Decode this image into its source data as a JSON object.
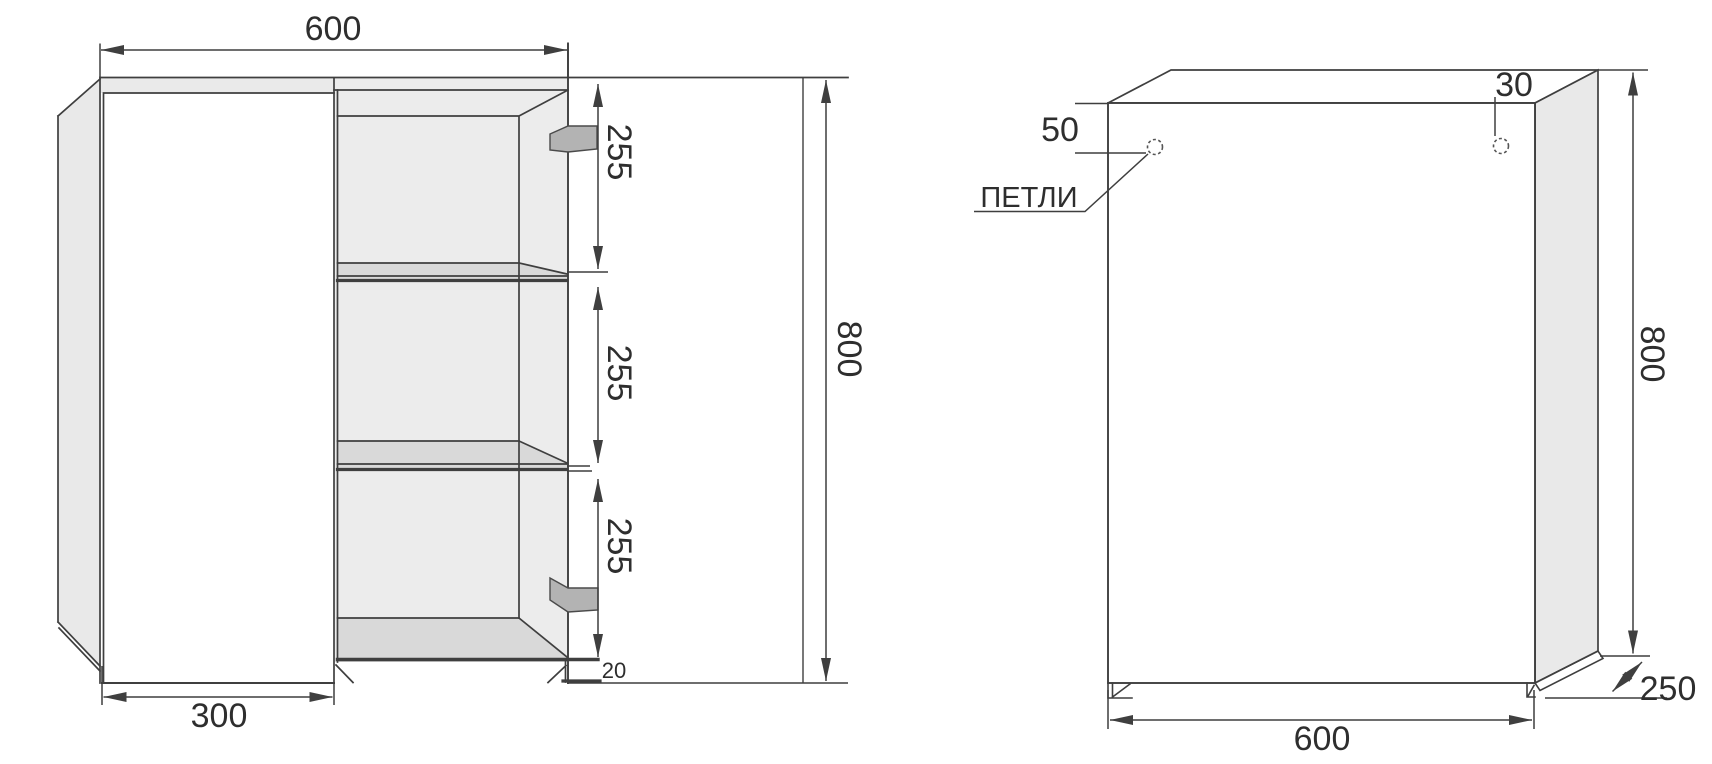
{
  "drawing": {
    "left_view": {
      "width_top": "600",
      "door_width": "300",
      "height": "800",
      "shelf_spacings": [
        "255",
        "255",
        "255"
      ],
      "bottom_inset": "20"
    },
    "right_view": {
      "width_bottom": "600",
      "height": "800",
      "depth": "250",
      "hinge_offset_left": "50",
      "hinge_offset_right": "30",
      "hinges_label": "ПЕТЛИ"
    },
    "colors": {
      "line": "#3f3f3f",
      "panel_fill": "#e9e9e9",
      "compartment_fill": "#ececec",
      "shelf_fill": "#d9d9d9",
      "bracket_fill": "#b3b3b3",
      "text": "#2e2e2e"
    }
  }
}
